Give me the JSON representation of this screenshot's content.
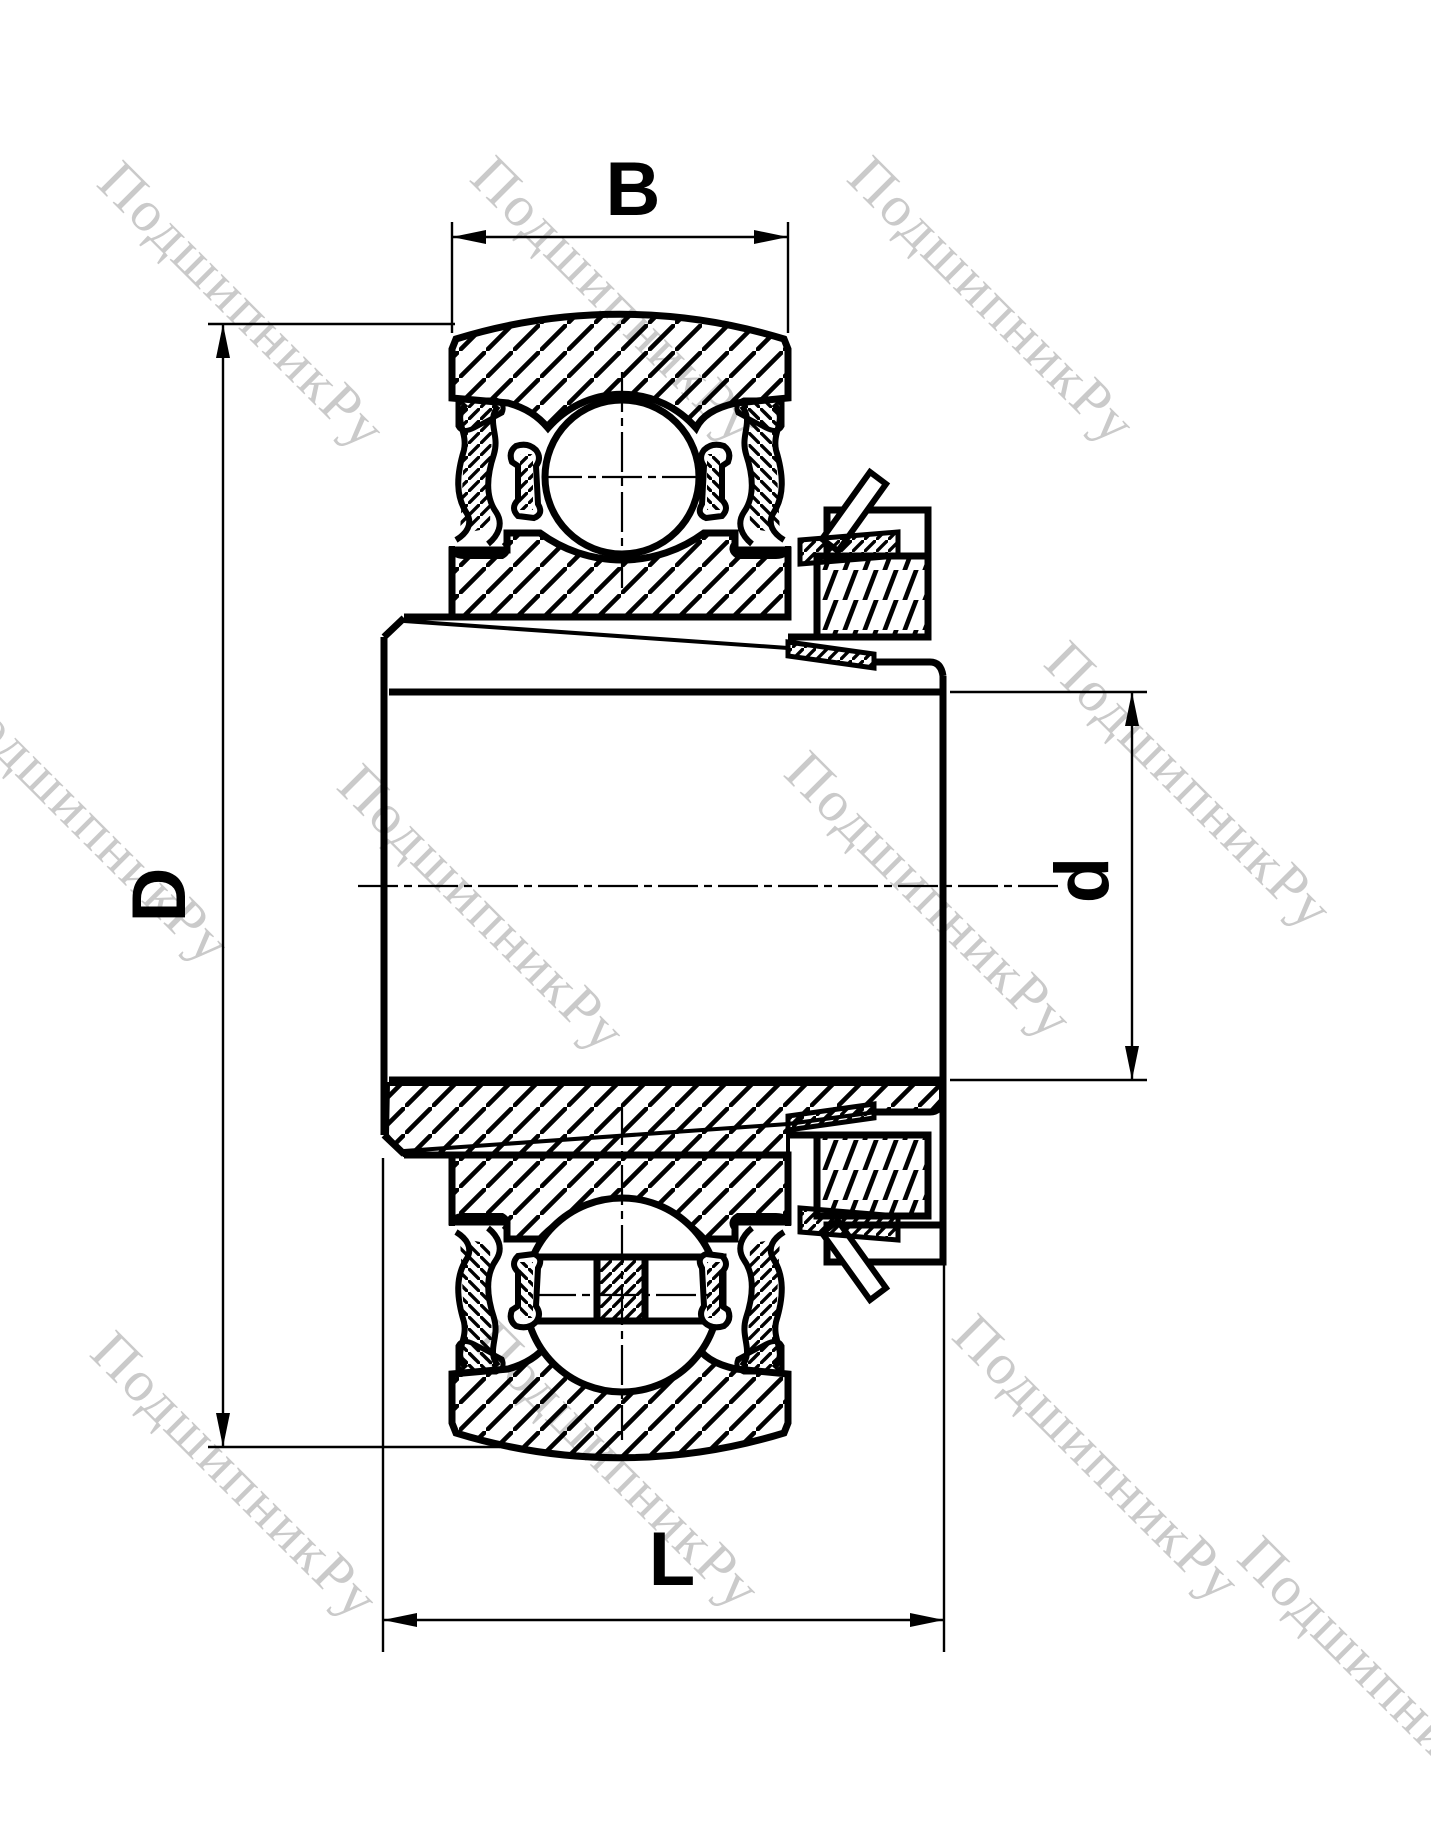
{
  "drawing": {
    "title": "bearing-cross-section",
    "type": "insert ball bearing with eccentric locking collar, sectional view",
    "dimensions": {
      "outer_ring_width_label": "B",
      "outer_sphere_diameter_label": "D",
      "bore_diameter_label": "d",
      "total_inner_ring_length_label": "L"
    },
    "watermark": {
      "text": "ПодшипникРу",
      "color": "#cacaca"
    },
    "colors": {
      "line": "#000000",
      "background": "#ffffff"
    }
  }
}
